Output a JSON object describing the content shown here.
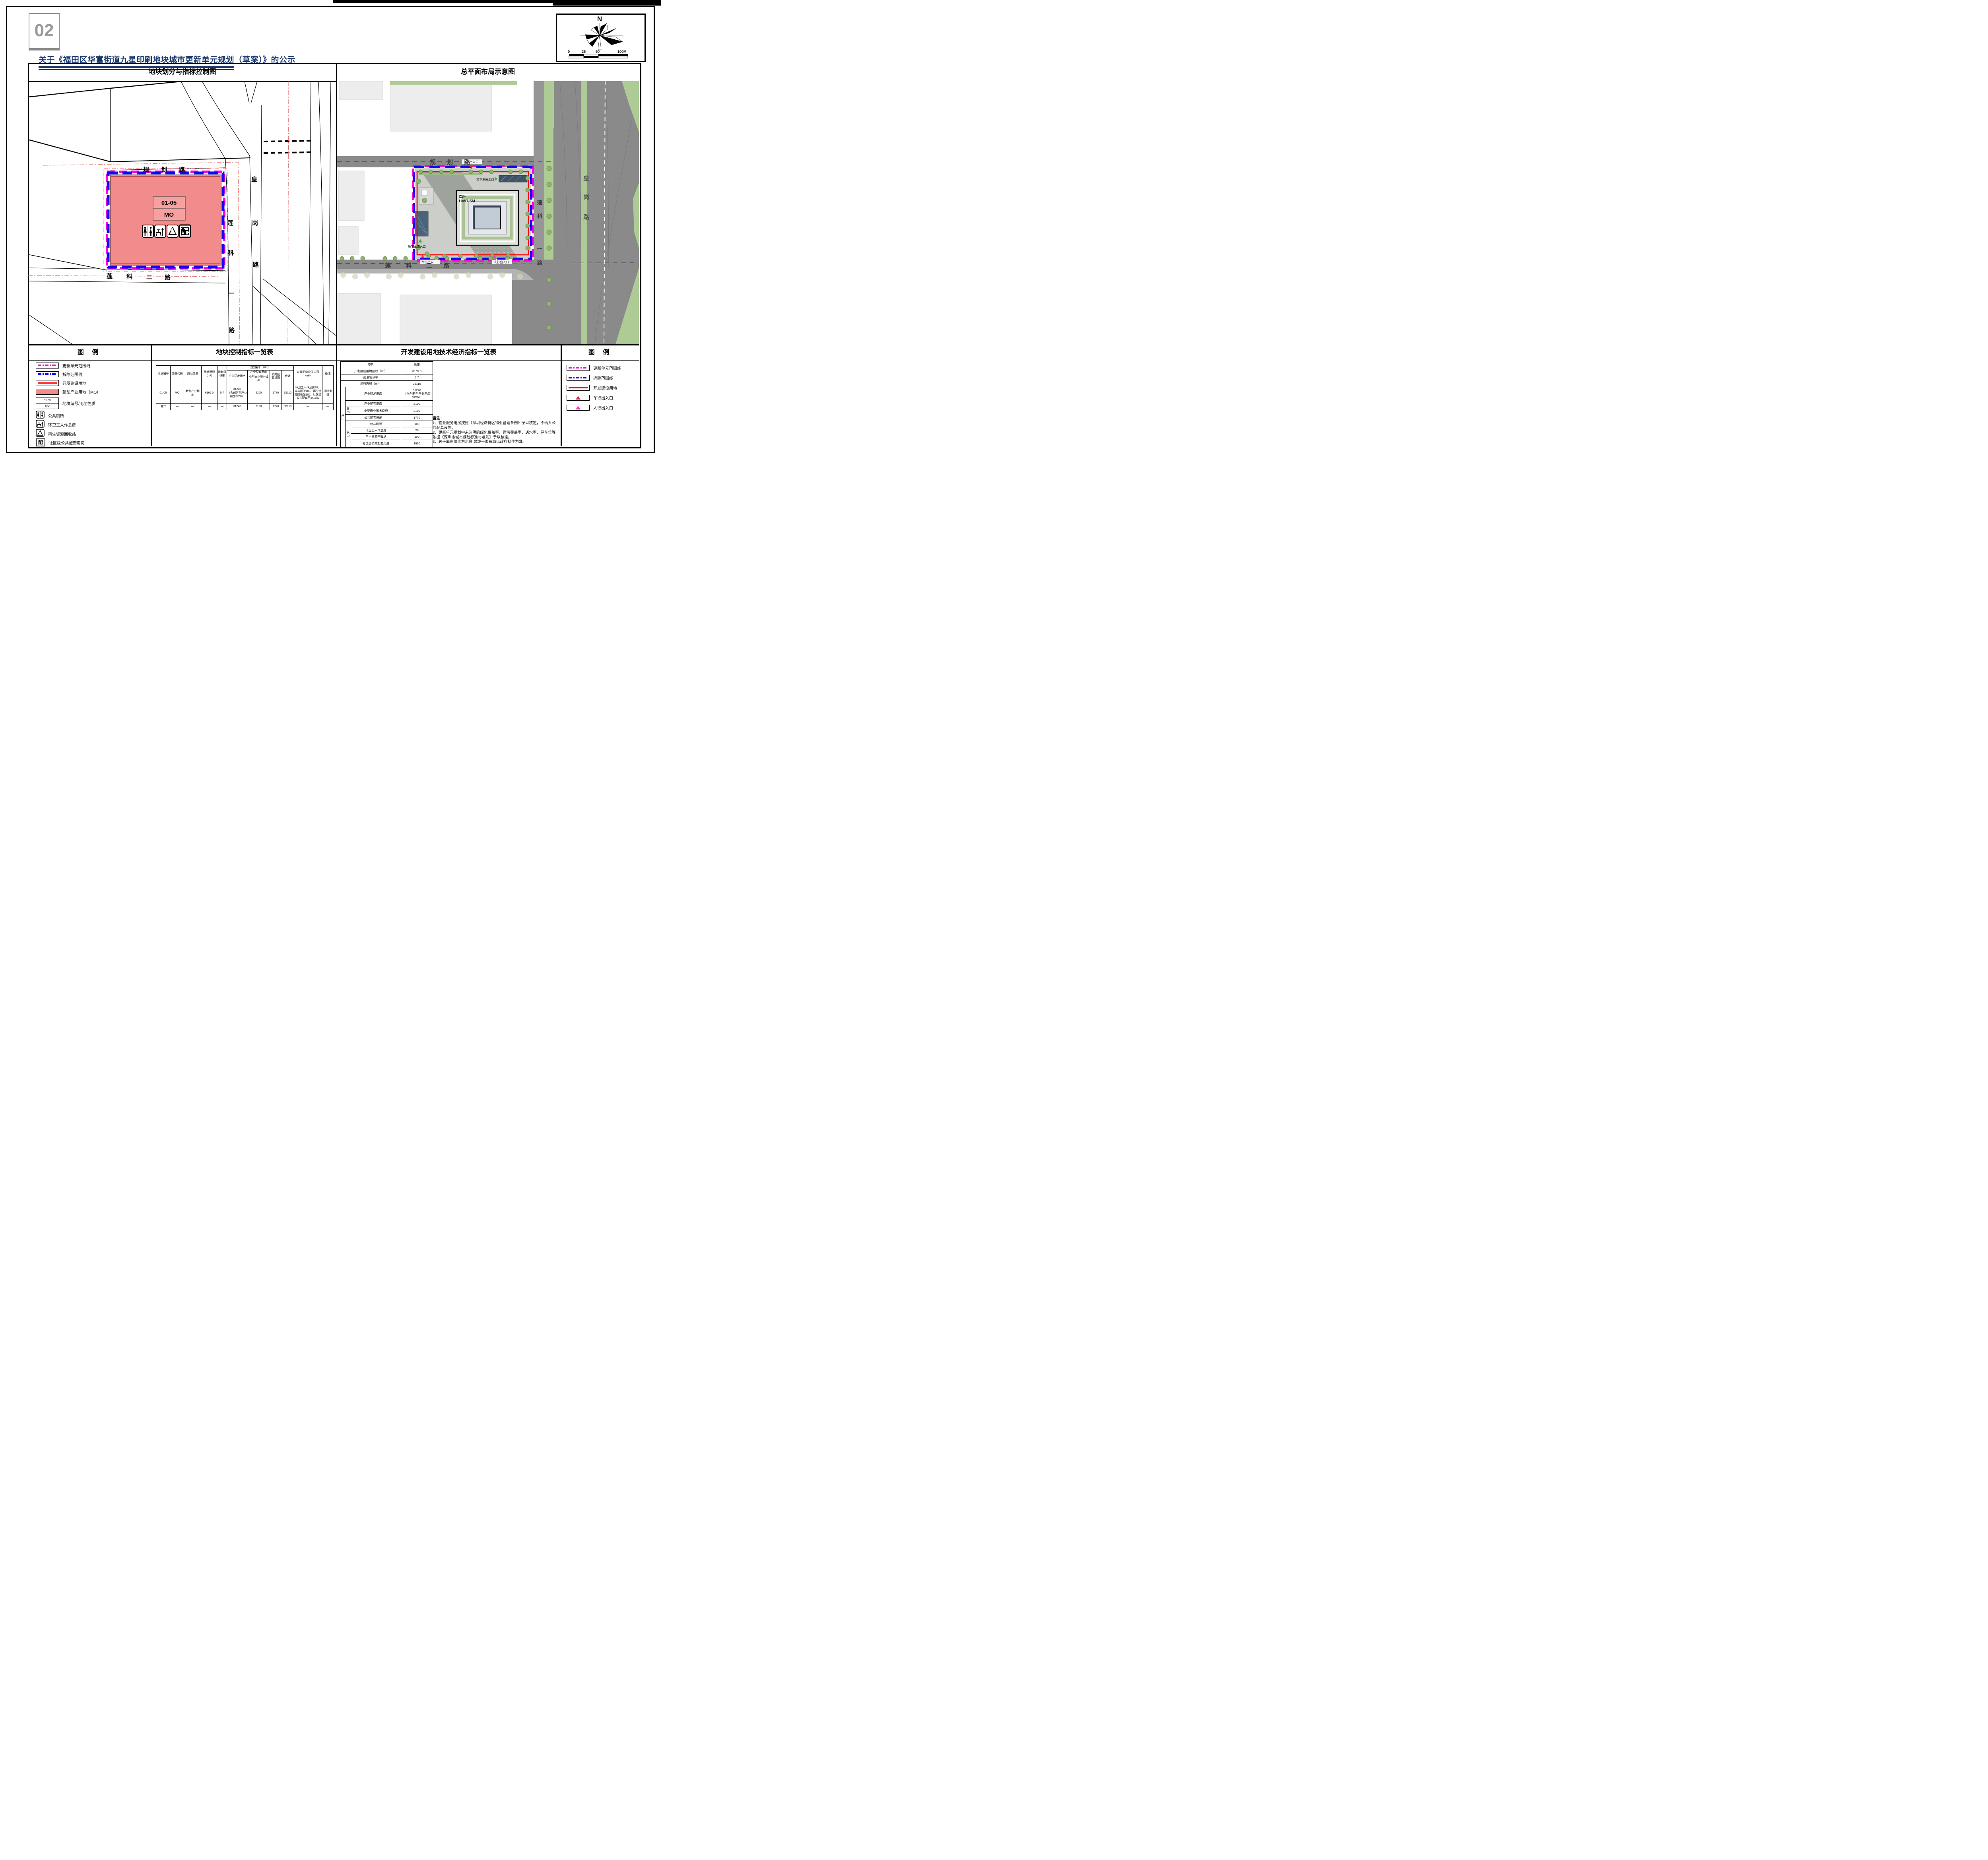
{
  "page": {
    "number": "02",
    "title": "关于《福田区华富街道九星印刷地块城市更新单元规划（草案）》的公示"
  },
  "compass": {
    "north_label": "N",
    "ticks": [
      "0",
      "25",
      "50",
      "100M"
    ]
  },
  "panels": {
    "left_map_title": "地块划分与指标控制图",
    "right_map_title": "总平面布局示意图"
  },
  "left_map": {
    "plot": {
      "code": "01-05",
      "use": "MO"
    },
    "pei": "配",
    "roads": {
      "guihua": "规 划 路",
      "lianke2": [
        "莲",
        "科",
        "二",
        "路"
      ],
      "lianke1": [
        "莲",
        "科",
        "一",
        "路"
      ],
      "huanggang": [
        "皇",
        "岗",
        "路"
      ]
    }
  },
  "right_map": {
    "building": {
      "floors": "21F",
      "height": "H=97.5M"
    },
    "roads": {
      "guihua": "规 划 路",
      "lianke2": [
        "莲",
        "科",
        "二",
        "路"
      ],
      "lianke1": [
        "莲",
        "科",
        "一",
        "路"
      ],
      "huanggang": [
        "皇",
        "岗",
        "路"
      ]
    },
    "entrances": {
      "vehicle_top": "车行出入口",
      "vehicle_bottom": "车行出入口",
      "pedestrian": "人行出入口",
      "garage_in": "地下车库入口",
      "garage_out": "地下车库出口"
    }
  },
  "legend_left": {
    "title": "图 例",
    "items": [
      "更新单元范围线",
      "拆除范围线",
      "开发建设用地",
      "新型产业用地（MO）",
      "地块编号/用地性质",
      "公共厕所",
      "环卫工人作息房",
      "再生资源回收站",
      "社区级公共配套用房"
    ],
    "plot_code": "01-05",
    "plot_use": "MO",
    "pei": "配"
  },
  "legend_right": {
    "title": "图 例",
    "items": [
      "更新单元范围线",
      "拆除范围线",
      "开发建设用地",
      "车行出入口",
      "人行出入口"
    ]
  },
  "mid_table": {
    "title": "地块控制指标一览表",
    "headers": {
      "plot_no": "地块编号",
      "code": "性质代码",
      "use": "用地性质",
      "area": "用地面积（m²）",
      "far": "规划容积率",
      "group": "规划容积（m²）",
      "rd": "产业研发用房",
      "support": "产业配套用房",
      "small_biz": "小型商业服务设施",
      "public": "公共配套设施",
      "total": "合计",
      "content": "公共配套设施内容（m²）",
      "remark": "备注"
    },
    "row": [
      "01-05",
      "MO",
      "新型产业用地",
      "6165.0",
      "5.7",
      "31240\n（含创新型产业用房3750）",
      "2100",
      "1770",
      "35110",
      "环卫工人作息房20、公共厕所100、再生资源回收站100、社区级公共配套用房1550",
      "拆除重建"
    ],
    "total_row": [
      "合计",
      "—",
      "—",
      "—",
      "—",
      "31240",
      "2100",
      "1770",
      "35110",
      "—",
      "—"
    ]
  },
  "right_table": {
    "title": "开发建设用地技术经济指标一览表",
    "col_item": "项目",
    "col_qty": "数量",
    "qizhong": "其中",
    "rows": [
      [
        "开发建设用地面积（m²）",
        "6165.0"
      ],
      [
        "规划容积率",
        "5.7"
      ],
      [
        "规划容积（m²）",
        "35110"
      ],
      [
        "产业研发用房",
        "31240\n（含创新型产业用房3750）"
      ],
      [
        "产业配套用房",
        "2100"
      ],
      [
        "小型商业服务设施",
        "2100"
      ],
      [
        "公共配套设施",
        "1770"
      ],
      [
        "公共厕所",
        "100"
      ],
      [
        "环卫工人作息房",
        "20"
      ],
      [
        "再生资源回收站",
        "100"
      ],
      [
        "社区级公共配套用房",
        "1550"
      ]
    ]
  },
  "notes": {
    "heading": "备注：",
    "lines": [
      "1、物业服务用房按照《深圳经济特区物业管理条例》予以核定，不纳入公共配套设施。",
      "2、更新单元规划中未注明的绿化覆盖率、建筑覆盖率、透水率、停车位等依据《深圳市城市规划标准与准则》予以核定。",
      "3、总平面图仅作为示意,最终平面布局以政府批件为准。"
    ]
  }
}
